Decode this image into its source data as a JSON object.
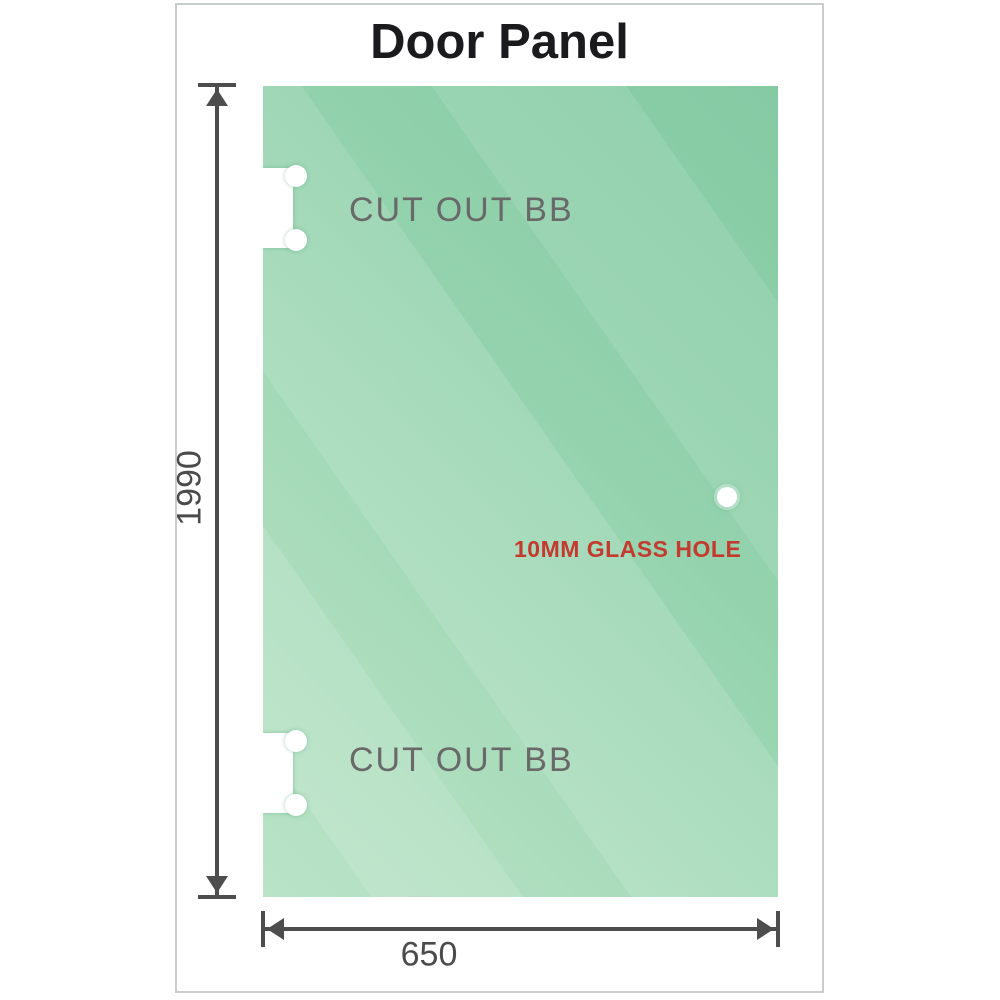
{
  "title": "Door Panel",
  "panel": {
    "cutouts": [
      {
        "label": "CUT OUT BB"
      },
      {
        "label": "CUT OUT BB"
      }
    ],
    "hole": {
      "label": "10MM GLASS HOLE"
    }
  },
  "dimensions": {
    "height": "1990",
    "width": "650"
  },
  "colors": {
    "glass_dark": "#84caa3",
    "glass_light": "#bae3c7",
    "dimension_line": "#4d4d4d",
    "cutout_label_gray": "#696969",
    "hole_label_red": "#c23b2e",
    "title_color": "#1b1b1e",
    "frame_border": "#c9cdcc"
  }
}
